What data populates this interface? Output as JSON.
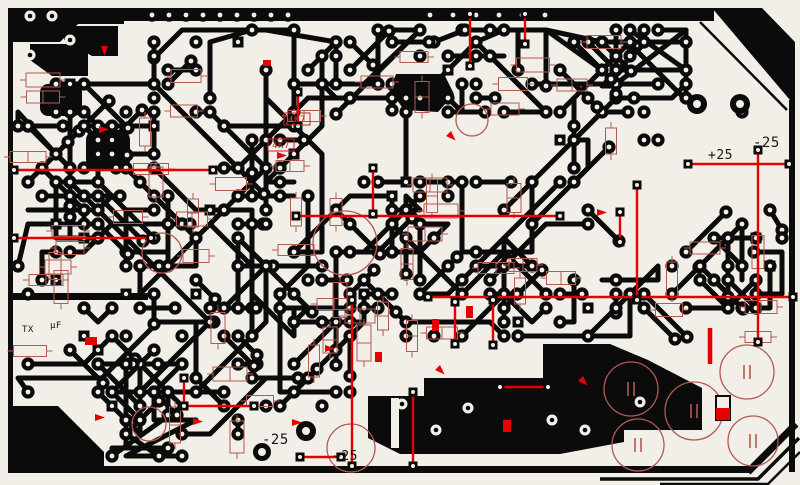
{
  "title": "Printed circuit board copper trace layout with red silkscreen overlay",
  "colors": {
    "background": "#f2efe8",
    "copper": "#0b0b0b",
    "silk": "#b05a52",
    "jumper": "#e60000",
    "label_red": "#cc2222",
    "label_black": "#161616"
  },
  "labels": [
    {
      "text": "4K7",
      "x": 297,
      "y": 122,
      "size": 9,
      "color": "red",
      "boxed": true,
      "bx": 284,
      "by": 113,
      "bw": 26,
      "bh": 12
    },
    {
      "text": "4K7",
      "x": 281,
      "y": 148,
      "size": 9,
      "color": "red",
      "boxed": true,
      "bx": 268,
      "by": 139,
      "bw": 26,
      "bh": 12
    },
    {
      "text": "-25",
      "x": 753,
      "y": 147,
      "size": 14,
      "color": "black",
      "boxed": false
    },
    {
      "text": "+25",
      "x": 708,
      "y": 159,
      "size": 13,
      "color": "black",
      "boxed": false
    },
    {
      "text": "TX",
      "x": 22,
      "y": 332,
      "size": 9,
      "color": "black",
      "boxed": false
    },
    {
      "text": "µF",
      "x": 50,
      "y": 328,
      "size": 9,
      "color": "black",
      "boxed": false
    },
    {
      "text": "-25",
      "x": 262,
      "y": 444,
      "size": 14,
      "color": "black",
      "boxed": false
    },
    {
      "text": "+25",
      "x": 333,
      "y": 460,
      "size": 13,
      "color": "black",
      "boxed": false
    }
  ],
  "generator": {
    "seed": 13,
    "traces": 100,
    "links": 80,
    "lone_pads": 60,
    "squares": 24,
    "outlines": 64,
    "exclusions": [
      [
        330,
        122,
        215,
        58
      ],
      [
        598,
        152,
        145,
        58
      ],
      [
        615,
        345,
        175,
        115
      ],
      [
        700,
        28,
        88,
        70
      ],
      [
        700,
        118,
        95,
        55
      ],
      [
        240,
        420,
        135,
        48
      ],
      [
        16,
        305,
        62,
        34
      ],
      [
        368,
        340,
        334,
        118
      ],
      [
        8,
        8,
        122,
        64
      ],
      [
        8,
        400,
        100,
        70
      ]
    ]
  },
  "artwork": {
    "jumpers_h": [
      [
        14,
        170,
        213
      ],
      [
        14,
        238,
        151
      ],
      [
        296,
        216,
        560
      ],
      [
        428,
        297,
        793
      ],
      [
        688,
        164,
        789
      ],
      [
        182,
        406,
        254
      ],
      [
        300,
        457,
        341
      ],
      [
        500,
        387,
        548
      ]
    ],
    "jumpers_v": [
      [
        470,
        14,
        66
      ],
      [
        525,
        14,
        44
      ],
      [
        298,
        92,
        126
      ],
      [
        637,
        185,
        300
      ],
      [
        758,
        150,
        342
      ],
      [
        184,
        378,
        406
      ],
      [
        352,
        300,
        466
      ],
      [
        413,
        392,
        466
      ],
      [
        493,
        300,
        345
      ],
      [
        455,
        302,
        344
      ],
      [
        373,
        168,
        214
      ],
      [
        620,
        212,
        242
      ]
    ],
    "thick_jumper": [
      710,
      328,
      364
    ],
    "arrows": [
      [
        99,
        126,
        0
      ],
      [
        277,
        152,
        0
      ],
      [
        451,
        131,
        45
      ],
      [
        597,
        209,
        0
      ],
      [
        325,
        345,
        0
      ],
      [
        292,
        419,
        0
      ],
      [
        193,
        418,
        0
      ],
      [
        95,
        414,
        0
      ],
      [
        583,
        376,
        45
      ],
      [
        108,
        46,
        90
      ],
      [
        440,
        365,
        45
      ]
    ],
    "marks": [
      [
        85,
        337,
        12,
        8
      ],
      [
        466,
        306,
        7,
        12
      ],
      [
        432,
        319,
        7,
        12
      ],
      [
        503,
        420,
        8,
        12
      ],
      [
        263,
        60,
        8,
        6
      ],
      [
        375,
        352,
        7,
        10
      ]
    ],
    "diode": [
      716,
      396,
      14,
      24
    ],
    "circles": [
      [
        631,
        389,
        27
      ],
      [
        638,
        445,
        26
      ],
      [
        694,
        411,
        29
      ],
      [
        747,
        372,
        27
      ],
      [
        753,
        441,
        25
      ],
      [
        351,
        448,
        24
      ],
      [
        162,
        253,
        20
      ],
      [
        149,
        424,
        17
      ],
      [
        345,
        243,
        32
      ],
      [
        472,
        120,
        16
      ]
    ],
    "cap_circle_count": 5,
    "pour_holes": [
      [
        402,
        404
      ],
      [
        436,
        430
      ],
      [
        468,
        408
      ],
      [
        552,
        420
      ],
      [
        640,
        402
      ],
      [
        585,
        430
      ],
      [
        30,
        16
      ],
      [
        52,
        16
      ],
      [
        30,
        55
      ],
      [
        70,
        40
      ]
    ],
    "big_pads": [
      [
        697,
        104,
        10
      ],
      [
        740,
        104,
        10
      ],
      [
        306,
        431,
        10
      ],
      [
        262,
        452,
        9
      ]
    ],
    "pad_rows": [
      [
        152,
        288,
        17,
        15,
        1
      ],
      [
        430,
        545,
        23,
        15,
        0
      ]
    ]
  }
}
